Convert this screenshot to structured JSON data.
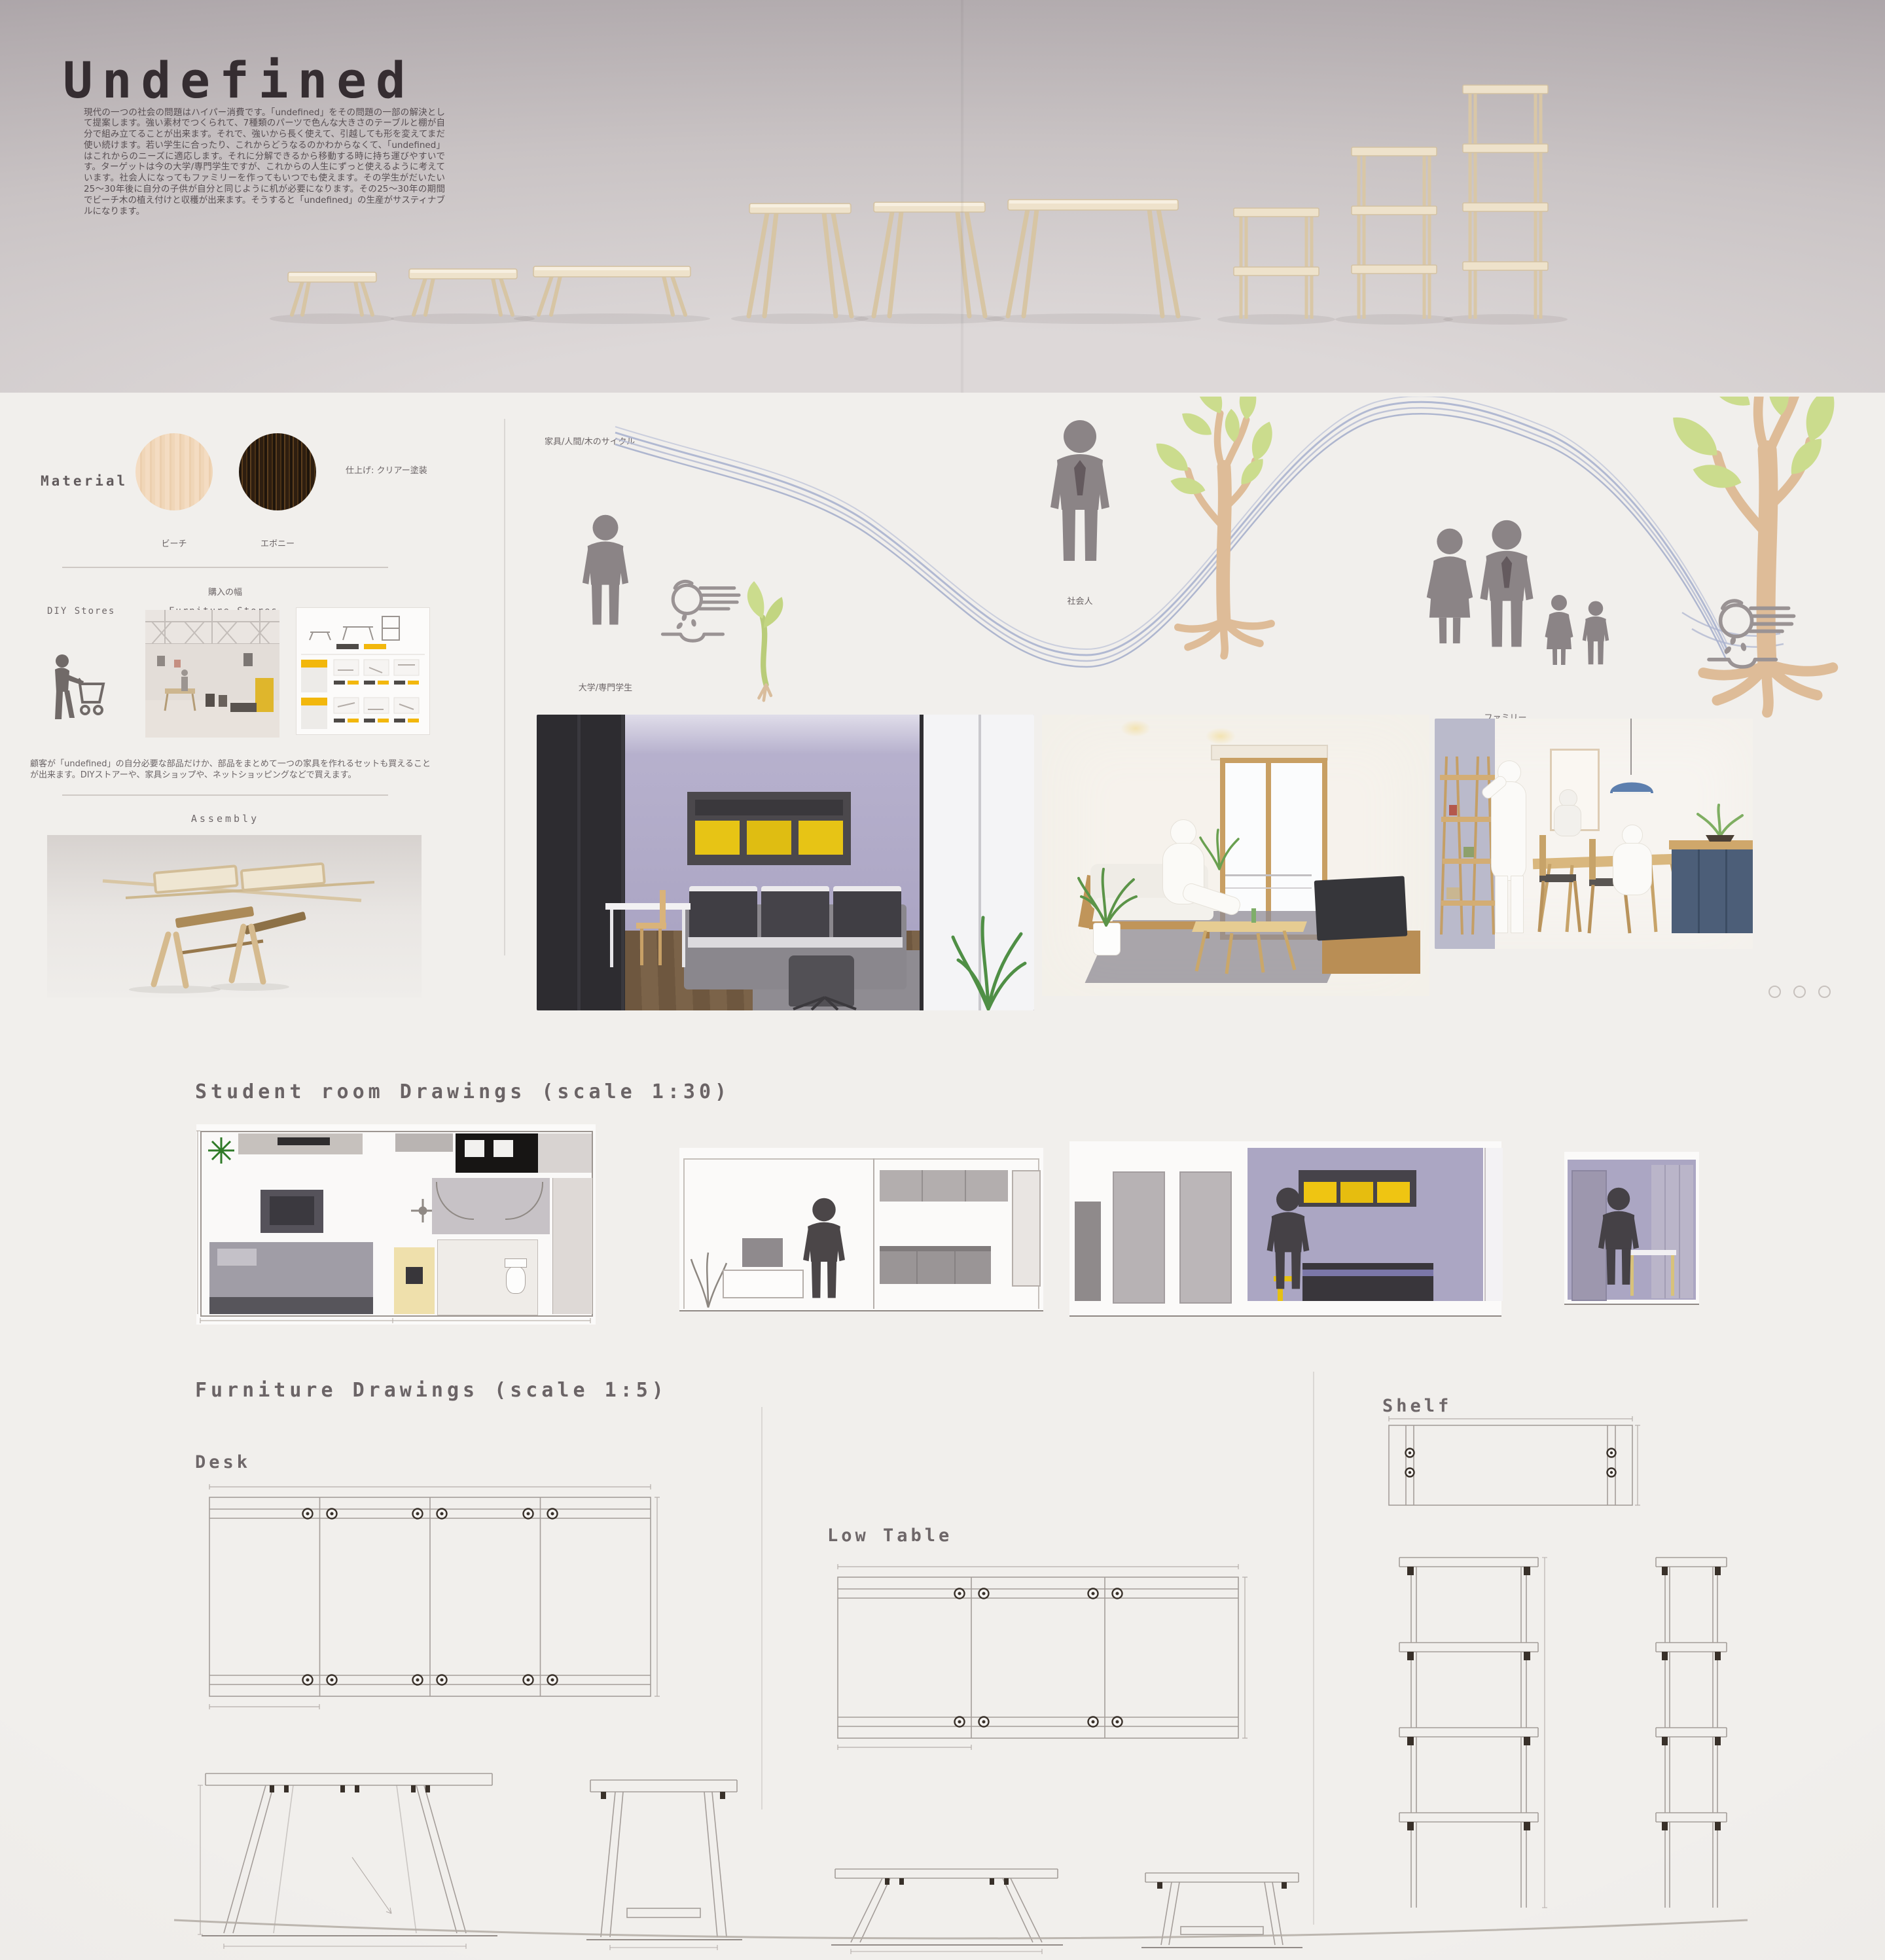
{
  "header": {
    "title": "Undefined",
    "intro": "現代の一つの社会の問題はハイパー消費です。「undefined」をその問題の一部の解決として提案します。強い素材でつくられて、7種類のパーツで色んな大きさのテーブルと棚が自分で組み立てることが出来ます。それで、強いから長く使えて、引越しても形を変えてまだ使い続けます。若い学生に合ったり、これからどうなるのかわからなくて、「undefined」はこれからのニーズに適応します。それに分解できるから移動する時に持ち運びやすいです。ターゲットは今の大学/専門学生ですが、これからの人生にずっと使えるように考えています。社会人になってもファミリーを作ってもいつでも使えます。その学生がだいたい25〜30年後に自分の子供が自分と同じように机が必要になります。その25〜30年の期間でビーチ木の植え付けと収穫が出来ます。そうすると「undefined」の生産がサスティナブルになります。"
  },
  "material": {
    "heading": "Material",
    "finish_note": "仕上げ: クリアー塗装",
    "beech_label": "ビーチ",
    "ebony_label": "エボニー"
  },
  "purchase": {
    "heading": "購入の幅",
    "channels": [
      "DIY Stores",
      "Furniture Stores",
      "e-commerce"
    ],
    "note": "顧客が「undefined」の自分必要な部品だけか、部品をまとめて一つの家具を作れるセットも買えることが出来ます。DIYストアーや、家具ショップや、ネットショッピングなどで買えます。"
  },
  "assembly": {
    "heading": "Assembly"
  },
  "cycle": {
    "heading": "家具/人間/木のサイクル",
    "label_student": "大学/専門学生",
    "label_adult": "社会人",
    "label_family": "ファミリー"
  },
  "drawings": {
    "student_room_heading": "Student room Drawings (scale 1:30)",
    "furniture_heading": "Furniture Drawings (scale 1:5)",
    "desk_label": "Desk",
    "low_table_label": "Low Table",
    "shelf_label": "Shelf"
  },
  "colors": {
    "accent_yellow": "#f0c31b",
    "beech": "#f3dcc1",
    "ebony": "#30200f",
    "ribbon_blue": "#a4adcb",
    "leaf_green": "#c9db8e",
    "trunk_tan": "#debc98",
    "pictogram_gray": "#8b8486",
    "wall_lavender": "#aca7c5"
  }
}
